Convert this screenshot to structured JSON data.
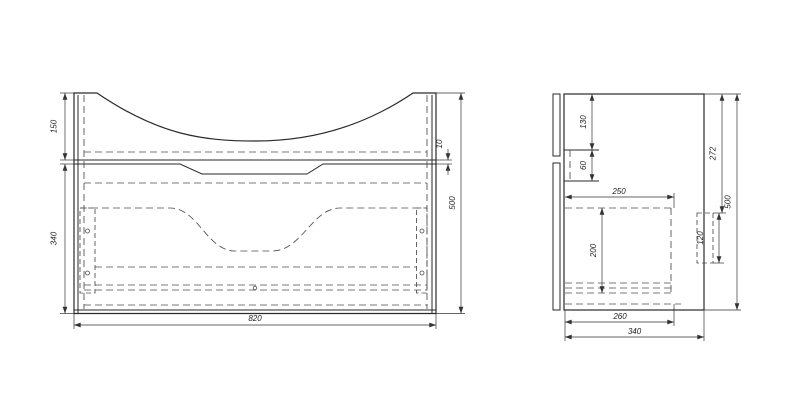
{
  "drawing": {
    "front_view": {
      "top_section_height": "150",
      "lower_section_height": "340",
      "seam_gap": "10",
      "overall_height": "500",
      "overall_width": "820"
    },
    "side_view": {
      "top_to_counter": "130",
      "counter_thickness": "60",
      "drawer_depth": "250",
      "drawer_height": "200",
      "bracket_height": "120",
      "upper_section_height": "272",
      "overall_height": "500",
      "inner_depth": "260",
      "overall_depth": "340"
    },
    "colors": {
      "line": "#2a2a2a",
      "hidden_line": "#4d4d4d",
      "dimension": "#333333",
      "background": "#ffffff"
    }
  }
}
